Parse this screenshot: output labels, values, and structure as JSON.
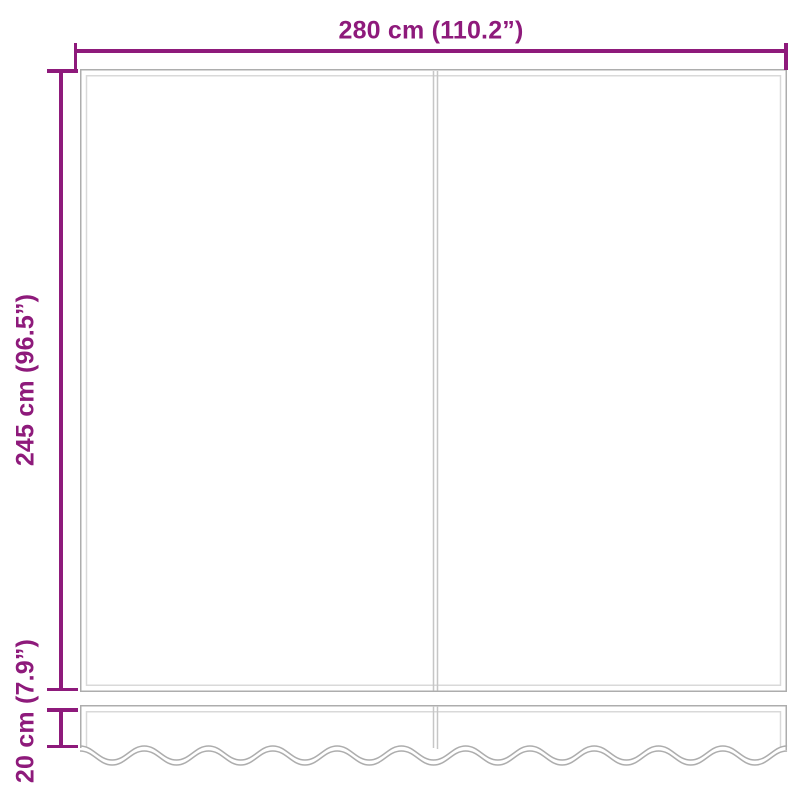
{
  "diagram": {
    "type": "product-dimension-diagram",
    "labels": {
      "width": "280 cm (110.2”)",
      "height": "245 cm (96.5”)",
      "valance_height": "20 cm (7.9”)"
    },
    "measurements": {
      "width_cm": 280,
      "width_inch": 110.2,
      "height_cm": 245,
      "height_inch": 96.5,
      "valance_height_cm": 20,
      "valance_height_inch": 7.9
    },
    "colors": {
      "accent": "#8e1a7b",
      "outline": "#adadad",
      "seam": "#d9d9d9",
      "divider": "#c6c6c6",
      "background": "#ffffff"
    }
  }
}
